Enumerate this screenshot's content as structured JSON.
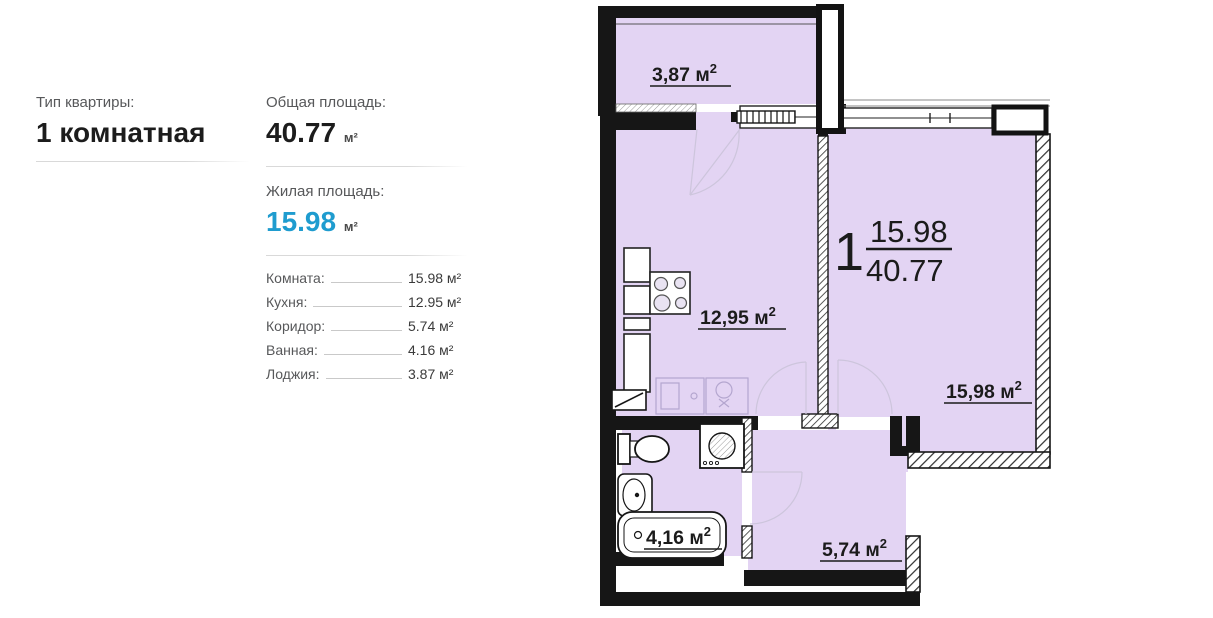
{
  "info_panel": {
    "type_label": "Тип квартиры:",
    "type_value": "1 комнатная",
    "total_area_label": "Общая площадь:",
    "total_area_value": "40.77",
    "total_area_unit": "м²",
    "living_area_label": "Жилая площадь:",
    "living_area_value": "15.98",
    "living_area_unit": "м²",
    "living_area_color": "#1f9ccf",
    "rooms": [
      {
        "label": "Комната:",
        "value": "15.98 м²"
      },
      {
        "label": "Кухня:",
        "value": "12.95 м²"
      },
      {
        "label": "Коридор:",
        "value": "5.74 м²"
      },
      {
        "label": "Ванная:",
        "value": "4.16 м²"
      },
      {
        "label": "Лоджия:",
        "value": "3.87 м²"
      }
    ]
  },
  "floor_plan": {
    "room_number": "1",
    "fraction_top": "15.98",
    "fraction_bottom": "40.77",
    "fill_color": "#e3d4f3",
    "labels": {
      "loggia": {
        "text": "3,87 м",
        "sup": "2"
      },
      "kitchen": {
        "text": "12,95 м",
        "sup": "2"
      },
      "room": {
        "text": "15,98 м",
        "sup": "2"
      },
      "bathroom": {
        "text": "4,16 м",
        "sup": "2"
      },
      "corridor": {
        "text": "5,74 м",
        "sup": "2"
      }
    }
  }
}
